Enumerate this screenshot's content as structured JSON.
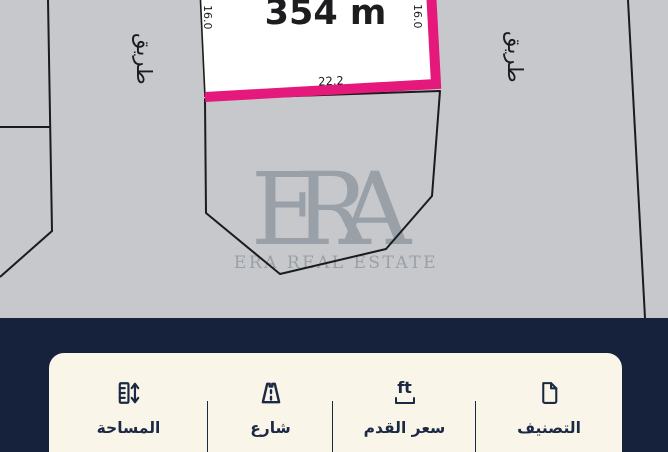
{
  "map": {
    "highlighted_plot": {
      "area_label": "354 m",
      "bottom_dimension": "22.2",
      "left_dimension": "16.0",
      "right_dimension": "16.0"
    },
    "road_label_left": "طريق",
    "road_label_right": "طريق",
    "watermark": {
      "logo": "ERA",
      "tagline": "ERA REAL ESTATE"
    }
  },
  "info_bar": {
    "items": [
      {
        "label": "التصنيف",
        "icon": "document-icon"
      },
      {
        "label": "سعر القدم",
        "icon": "price-per-foot-icon",
        "icon_text": "ft"
      },
      {
        "label": "شارع",
        "icon": "road-icon"
      },
      {
        "label": "المساحة",
        "icon": "area-ruler-icon"
      }
    ]
  },
  "colors": {
    "highlight_pink": "#e5187b",
    "map_background": "#c6c8cb",
    "panel_navy": "#16213c",
    "card_cream": "#f9f5e9",
    "line_black": "#1b1b1d",
    "text_navy": "#1b2944",
    "watermark_gray": "#9aa0a8"
  }
}
